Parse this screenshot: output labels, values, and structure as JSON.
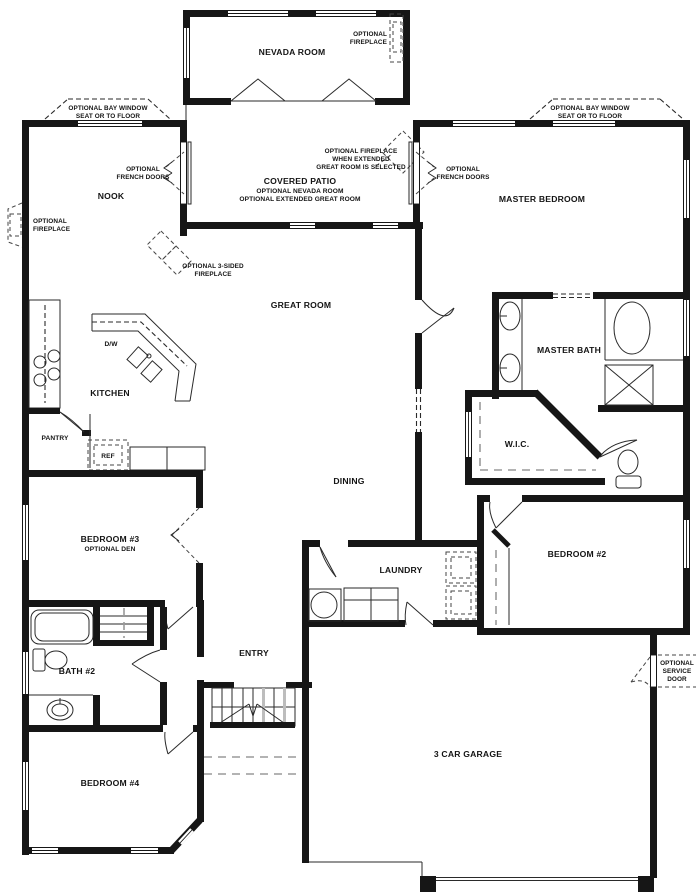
{
  "plan": {
    "rooms": {
      "nevada_room": "NEVADA ROOM",
      "covered_patio": "COVERED PATIO",
      "covered_patio_sub1": "OPTIONAL NEVADA ROOM",
      "covered_patio_sub2": "OPTIONAL EXTENDED GREAT ROOM",
      "nook": "NOOK",
      "master_bedroom": "MASTER BEDROOM",
      "great_room": "GREAT ROOM",
      "kitchen": "KITCHEN",
      "dw": "D/W",
      "pantry": "PANTRY",
      "ref": "REF",
      "master_bath": "MASTER BATH",
      "wic": "W.I.C.",
      "dining": "DINING",
      "bedroom3": "BEDROOM #3",
      "bedroom3_sub": "OPTIONAL DEN",
      "bedroom2": "BEDROOM #2",
      "laundry": "LAUNDRY",
      "bath2": "BATH #2",
      "entry": "ENTRY",
      "bedroom4": "BEDROOM #4",
      "garage": "3 CAR GARAGE"
    },
    "annotations": {
      "fireplace_nevada": {
        "l1": "OPTIONAL",
        "l2": "FIREPLACE"
      },
      "bay_left": {
        "l1": "OPTIONAL BAY WINDOW",
        "l2": "SEAT OR TO FLOOR"
      },
      "bay_right": {
        "l1": "OPTIONAL BAY WINDOW",
        "l2": "SEAT OR TO FLOOR"
      },
      "french_left": {
        "l1": "OPTIONAL",
        "l2": "FRENCH DOORS"
      },
      "french_right": {
        "l1": "OPTIONAL",
        "l2": "FRENCH DOORS"
      },
      "fireplace_patio": {
        "l1": "OPTIONAL FIREPLACE",
        "l2": "WHEN EXTENDED",
        "l3": "GREAT ROOM IS SELECTED"
      },
      "fireplace_nook": {
        "l1": "OPTIONAL",
        "l2": "FIREPLACE"
      },
      "fireplace_3sided": {
        "l1": "OPTIONAL 3-SIDED",
        "l2": "FIREPLACE"
      },
      "service_door": {
        "l1": "OPTIONAL",
        "l2": "SERVICE",
        "l3": "DOOR"
      }
    },
    "colors": {
      "line": "#161616",
      "background": "#ffffff"
    }
  }
}
